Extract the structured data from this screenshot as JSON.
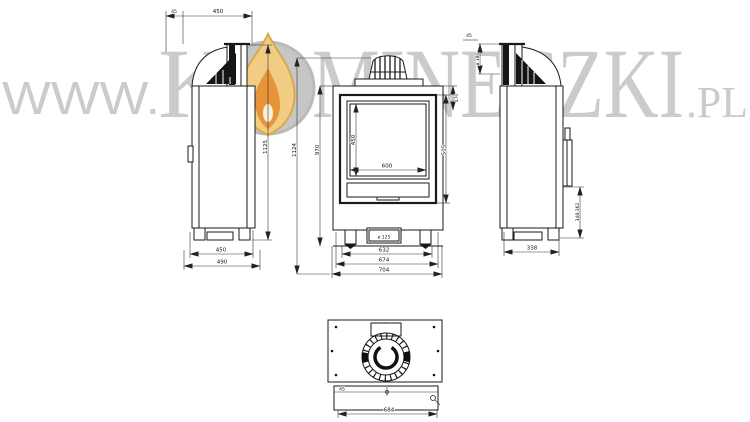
{
  "watermark": {
    "prefix": "WWW.",
    "brand_k": "K",
    "brand_rest": "MINECZKI",
    "suffix": ".PL",
    "color": "#c9c9c9",
    "flame_disc": "#c4c4c4",
    "flame_outer": "#f0cb7c",
    "flame_inner": "#e78f2e",
    "flame_core": "#fbf0d8"
  },
  "drawing": {
    "stroke": "#1a1a1a",
    "left_view": {
      "dim_top_offset": "45",
      "dim_top_width": "450",
      "dim_height": "1125",
      "dim_base_inner": "450",
      "dim_base_outer": "490"
    },
    "front_view": {
      "dim_total_height": "1124",
      "dim_body_height": "970",
      "dim_glass_height": "450",
      "dim_glass_width": "600",
      "dim_door_height": "515",
      "dim_top_right": "470",
      "dim_width_inner": "632",
      "dim_width_mid": "674",
      "dim_width_outer": "704",
      "dim_air_inlet": "ø 125"
    },
    "right_view": {
      "dim_flue": "ø 180",
      "dim_top": "45",
      "dim_side": "348-362",
      "dim_base": "338"
    },
    "bottom_view": {
      "dim_strip": "45",
      "dim_width": "684"
    }
  }
}
